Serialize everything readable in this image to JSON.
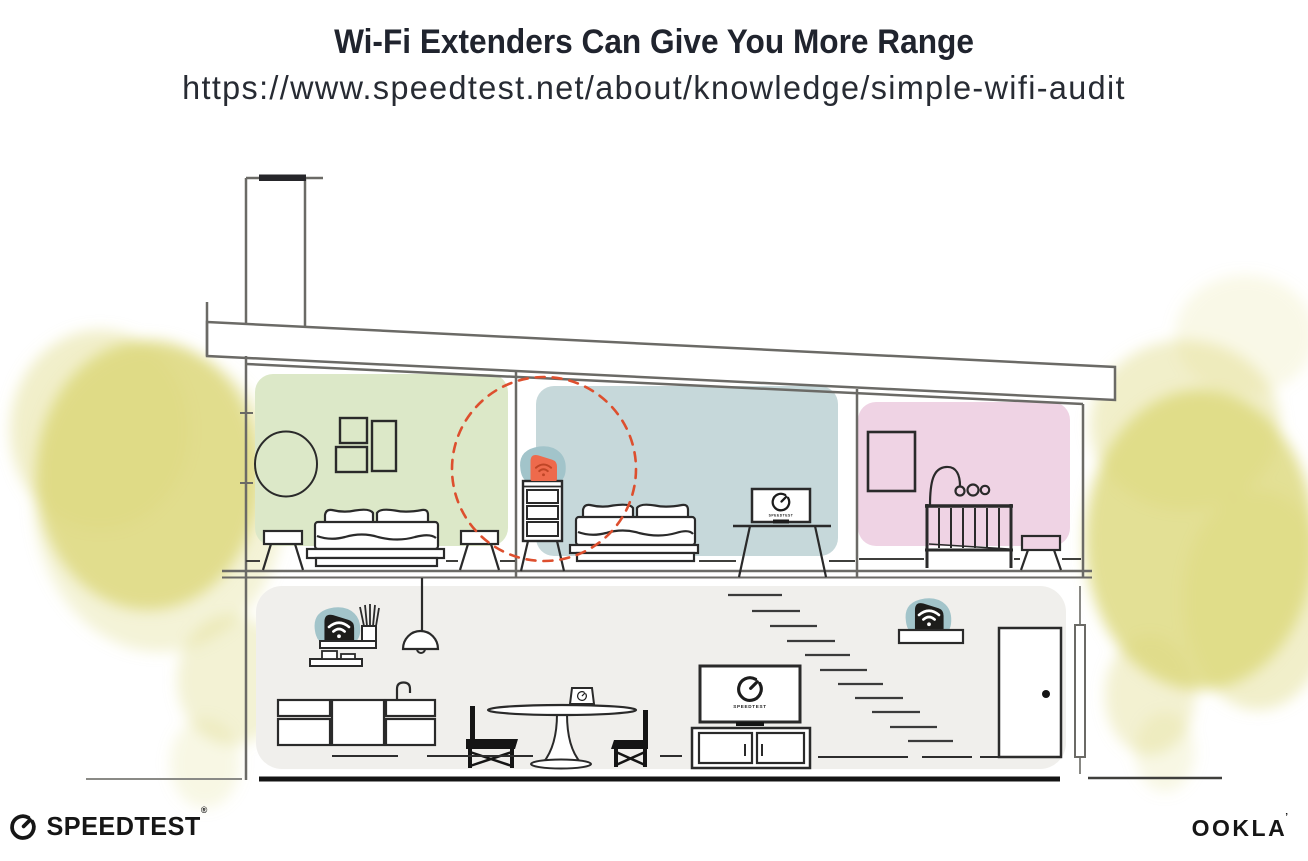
{
  "header": {
    "title": "Wi-Fi Extenders Can Give You More Range",
    "url": "https://www.speedtest.net/about/knowledge/simple-wifi-audit"
  },
  "illustration": {
    "tv_label": "SPEEDTEST",
    "range_circle": "wifi-extender-coverage-radius",
    "devices": [
      {
        "name": "wifi-extender-upstairs-dresser",
        "style": "orange"
      },
      {
        "name": "wifi-router-kitchen-shelf",
        "style": "black"
      },
      {
        "name": "wifi-extender-hall-shelf",
        "style": "black"
      }
    ]
  },
  "footer": {
    "speedtest": "SPEEDTEST",
    "speedtest_reg": "®",
    "ookla": "OOKLA",
    "ookla_mark": "’"
  },
  "colors": {
    "ink": "#20242e",
    "line-gray": "#6b6a66",
    "furniture-ink": "#2a2a2a",
    "room-green": "#dce8c8",
    "room-blue": "#c6d8da",
    "room-pink": "#efd3e4",
    "lower-gray": "#f0efec",
    "tree-yellow": "#dcd87b",
    "teal-blob": "#a2c4ca",
    "device-orange": "#ee6a4c",
    "wifi-on-orange": "#bf4526",
    "range-red": "#dd4f2e",
    "logo-ink": "#161616"
  }
}
